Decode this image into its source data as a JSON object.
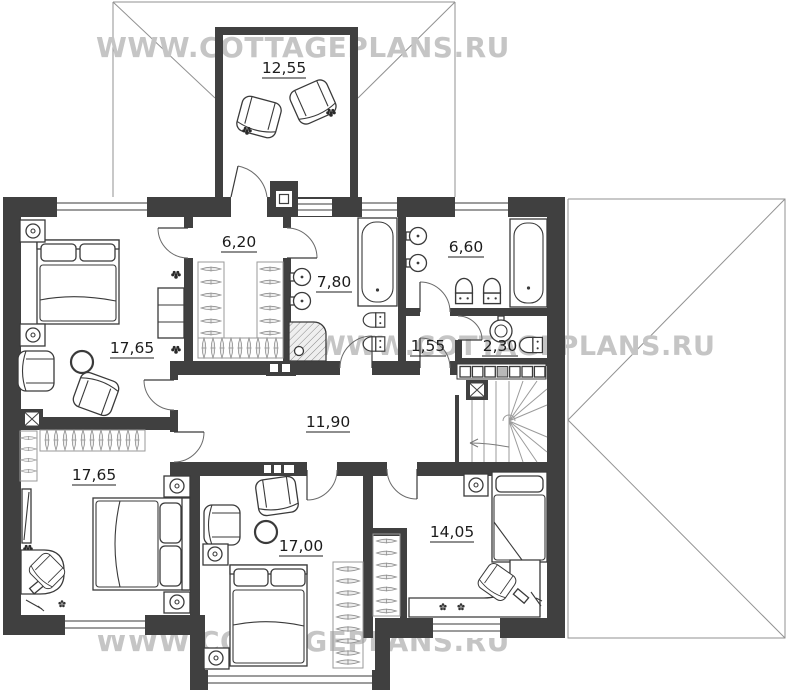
{
  "title": "Second floor plan",
  "watermark": {
    "text": "WWW.COTTAGEPLANS.RU",
    "color": "#c5c5c5"
  },
  "rooms": {
    "balcony": {
      "name": "balcony",
      "area": "12,55"
    },
    "master_bedroom": {
      "name": "master-bedroom",
      "area": "17,65"
    },
    "wardrobe": {
      "name": "walk-in-wardrobe",
      "area": "6,20"
    },
    "master_bath": {
      "name": "master-bathroom",
      "area": "7,80"
    },
    "bathroom": {
      "name": "bathroom",
      "area": "6,60"
    },
    "lobby": {
      "name": "lobby",
      "area": "1,55"
    },
    "wc": {
      "name": "wc",
      "area": "2,30"
    },
    "hall": {
      "name": "hall",
      "area": "11,90"
    },
    "bedroom_left": {
      "name": "bedroom-left",
      "area": "17,65"
    },
    "bedroom_middle": {
      "name": "bedroom-middle",
      "area": "17,00"
    },
    "bedroom_right": {
      "name": "bedroom-right",
      "area": "14,05"
    }
  },
  "colors": {
    "wall": "#404040",
    "furniture_line": "#3a3a3a",
    "roof_line": "#929292",
    "watermark": "#c5c5c5",
    "label": "#1c1c1c"
  }
}
